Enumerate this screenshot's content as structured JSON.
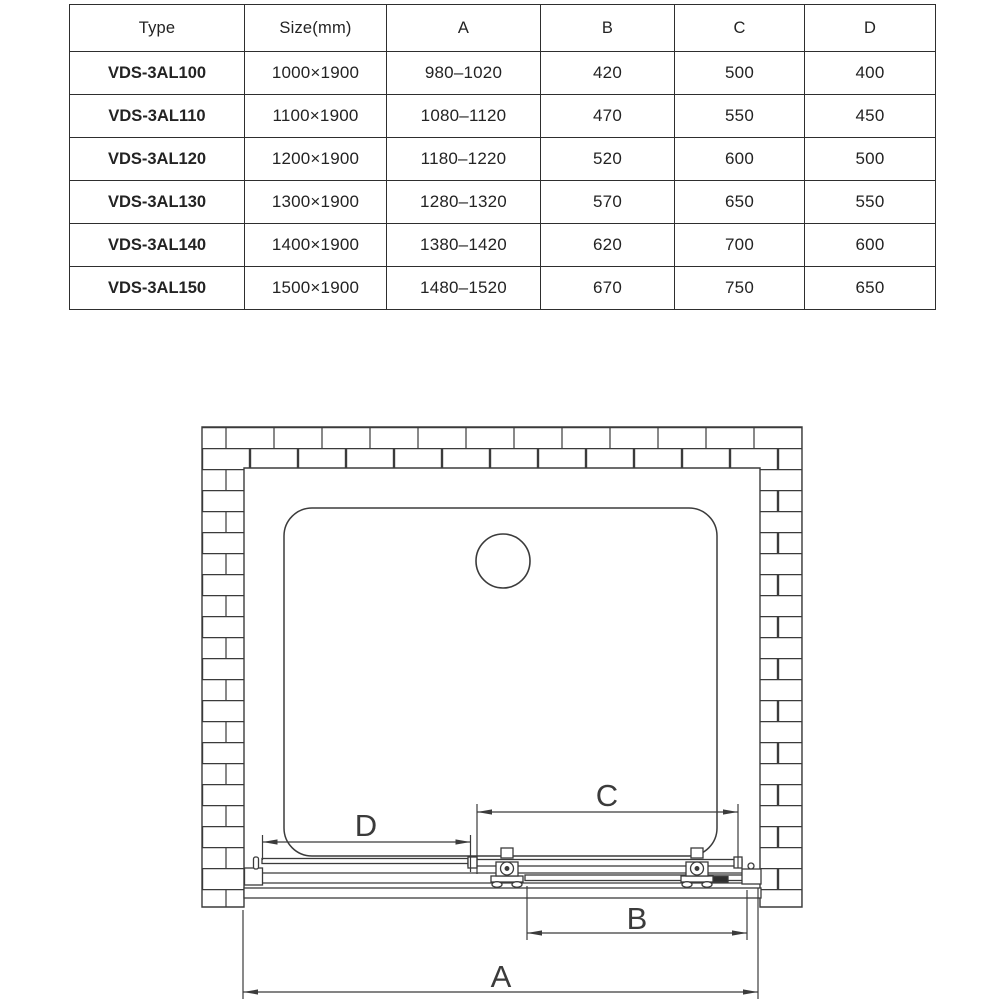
{
  "table": {
    "headers": [
      "Type",
      "Size(mm)",
      "A",
      "B",
      "C",
      "D"
    ],
    "rows": [
      [
        "VDS-3AL100",
        "1000×1900",
        "980–1020",
        "420",
        "500",
        "400"
      ],
      [
        "VDS-3AL110",
        "1100×1900",
        "1080–1120",
        "470",
        "550",
        "450"
      ],
      [
        "VDS-3AL120",
        "1200×1900",
        "1180–1220",
        "520",
        "600",
        "500"
      ],
      [
        "VDS-3AL130",
        "1300×1900",
        "1280–1320",
        "570",
        "650",
        "550"
      ],
      [
        "VDS-3AL140",
        "1400×1900",
        "1380–1420",
        "620",
        "700",
        "600"
      ],
      [
        "VDS-3AL150",
        "1500×1900",
        "1480–1520",
        "670",
        "750",
        "650"
      ]
    ]
  },
  "diagram": {
    "dimension_labels": {
      "a": "A",
      "b": "B",
      "c": "C",
      "d": "D"
    },
    "line_color": "#3b3b3b"
  }
}
